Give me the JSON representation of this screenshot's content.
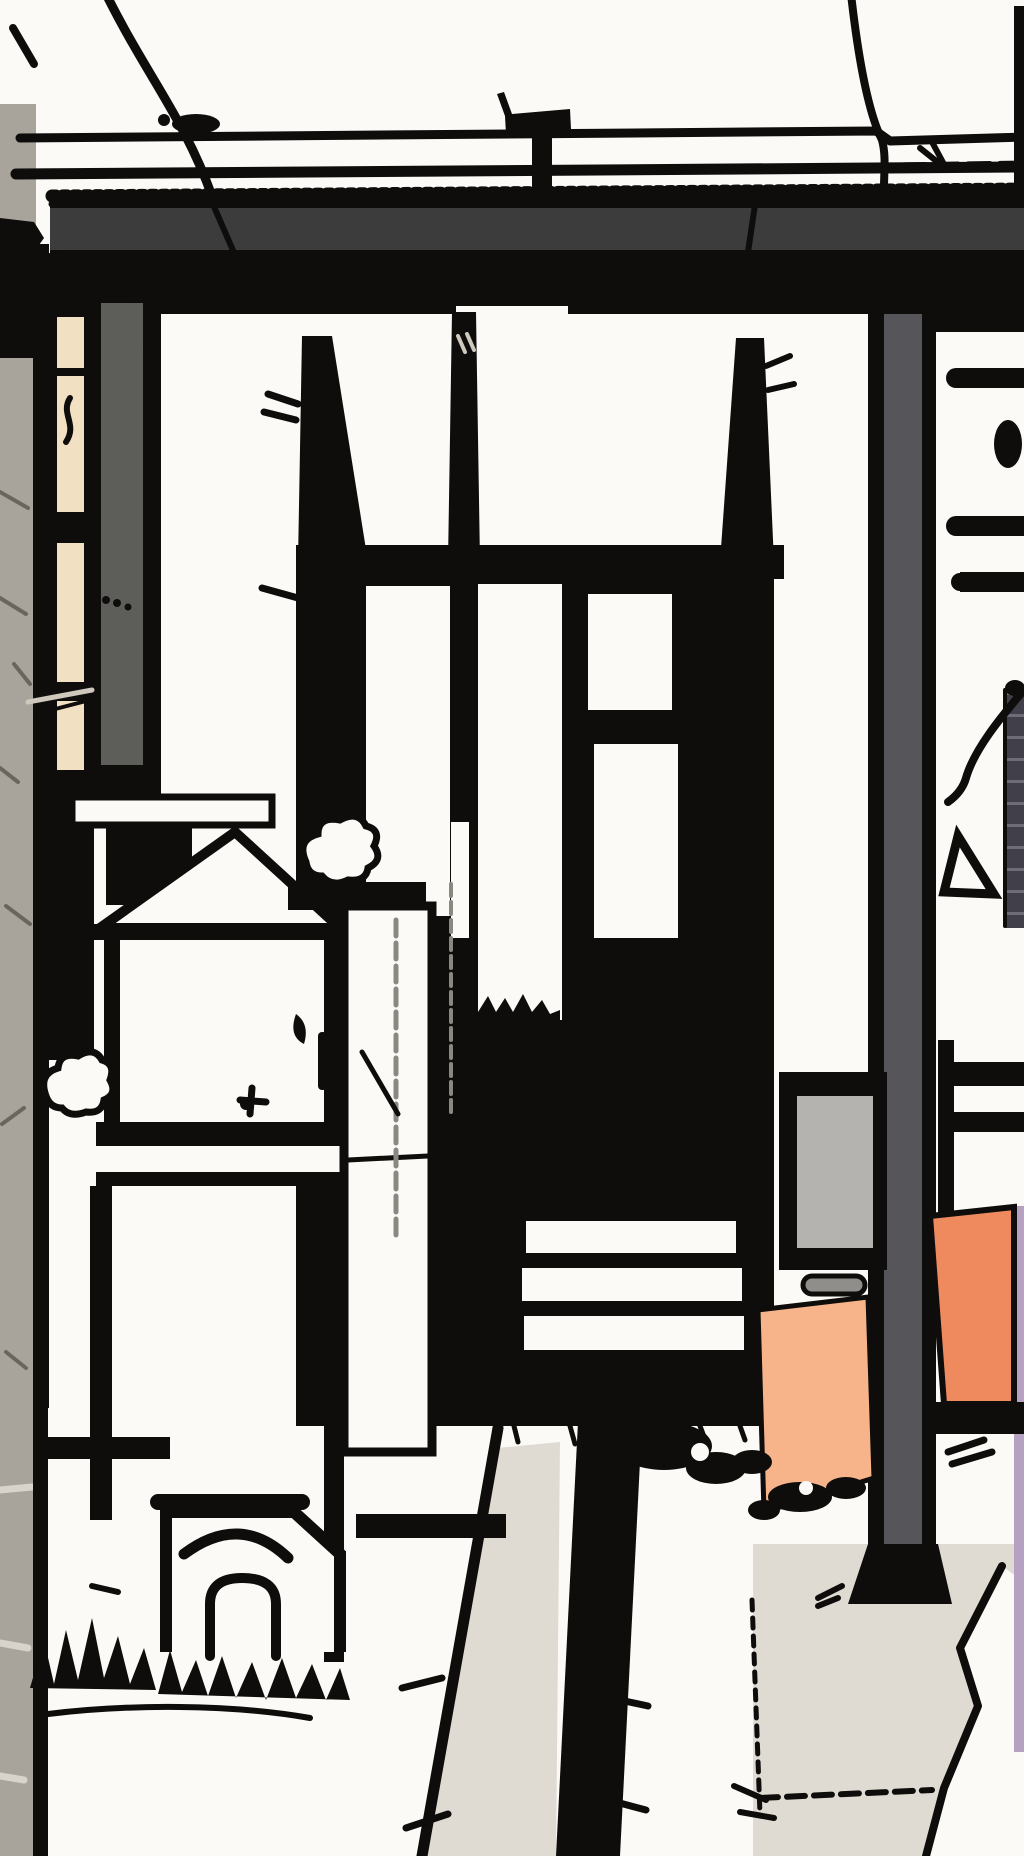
{
  "scene": {
    "kind": "monochrome manga-style street illustration with spot color",
    "description": "Black-and-white ink drawing of a narrow Japanese alley entrance seen through a dark gate beam: overhead wires, a vent pipe, a tall open doorway with glass panes and white step slats inside a dark interior, a small shrine hut with pitched roof and chimney beside a white vending cabinet, a stone offering box with arched niche, shrubs, a gray gate pillar, a sign board with a peach noren banner, a large orange banner at the right edge, a black walkway strip and cracked gray paving in the foreground",
    "elements": [
      {
        "name": "sky",
        "description": "blank white sky"
      },
      {
        "name": "power-lines",
        "description": "two thin horizontal wires above the gate"
      },
      {
        "name": "utility-cable-left",
        "description": "diagonal cable falling from top left onto the beam"
      },
      {
        "name": "utility-cable-right",
        "description": "cable curving down to the beam on the right"
      },
      {
        "name": "vent-pipe",
        "description": "small T-shaped standpipe behind the wires"
      },
      {
        "name": "gate-beam",
        "description": "heavy dark horizontal gate beam with scratched top edge and black shadow underside"
      },
      {
        "name": "left-wall",
        "description": "textured gray concrete wall strip at extreme left with cracks and tile joints"
      },
      {
        "name": "building-corner",
        "description": "black stepped roof-corner silhouette at upper left"
      },
      {
        "name": "left-gate-post",
        "description": "black post structure with a lit cream window slit and a gray face"
      },
      {
        "name": "doorway",
        "description": "tall open doorway with tapered posts, lintel, glass panes, dark interior and three white step slats"
      },
      {
        "name": "shrine-hut",
        "description": "small white hut with pitched roof, black chimney, shelf bands and legs"
      },
      {
        "name": "offering-box",
        "description": "white stone box with swoosh mark and arched niche at ground level"
      },
      {
        "name": "vending-cabinet",
        "description": "tall white cabinet with divider line and shading"
      },
      {
        "name": "shrub-left",
        "description": "scribbled white shrub in front of the left post"
      },
      {
        "name": "shrub-right",
        "description": "scribbled white shrub on the cabinet ledge"
      },
      {
        "name": "right-gate-pillar",
        "description": "gray vertical gate pillar with flared black base"
      },
      {
        "name": "side-fence",
        "description": "black rail and rungs behind the pillar at right"
      },
      {
        "name": "rolled-shutter",
        "description": "dark ribbed rolled screen at the right margin"
      },
      {
        "name": "hanging-wire",
        "description": "squiggly wire hanging at the right edge"
      },
      {
        "name": "flag-mark",
        "description": "small triangular flag doodle near the pillar"
      },
      {
        "name": "sign-board",
        "description": "framed light-gray sign panel with roller bar"
      },
      {
        "name": "noren-banner-small",
        "description": "peach banner hanging under the sign"
      },
      {
        "name": "noren-banner-large",
        "description": "large orange banner at the right edge with lavender sliver"
      },
      {
        "name": "walkway-path",
        "description": "black path strip running to the bottom edge"
      },
      {
        "name": "sidewalk",
        "description": "white sidewalk slab with front edge line"
      },
      {
        "name": "pavement",
        "description": "light gray paving with dotted cracks, zigzag crack and a white tile"
      },
      {
        "name": "grass-tufts",
        "description": "spiky ink grass along bases and edges"
      }
    ]
  },
  "colors": {
    "paper": "#fbfaf7",
    "ink": "#0e0d0b",
    "beam_gray": "#3c3c3c",
    "wall_gray": "#a9a49b",
    "wall_crack": "#6a665f",
    "wall_joint": "#d8d4cb",
    "cream_window": "#f2e0c2",
    "post_gray": "#5d5d5a",
    "pillar_gray": "#56565a",
    "sign_gray": "#b4b3b0",
    "roller_gray": "#8f8e8b",
    "banner_peach": "#f7b389",
    "banner_orange": "#ef8a5f",
    "lavender": "#b7a1c3",
    "pavement": "#dfdbd3",
    "shade_gray": "#8b8881",
    "shutter_dark": "#413f4a",
    "shutter_rib": "#6f6c79",
    "scratch_light": "#cfc9bd"
  }
}
